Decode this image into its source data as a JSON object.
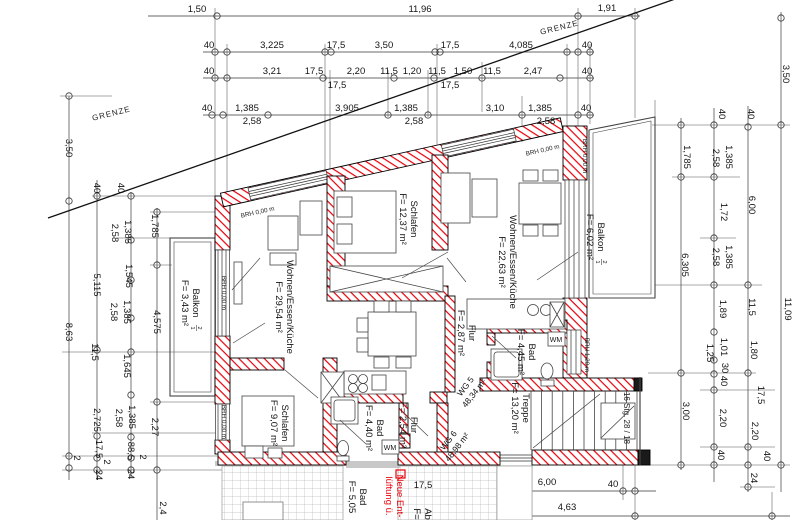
{
  "drawing": {
    "boundary_label_1": "GRENZE",
    "boundary_label_2": "GRENZE",
    "colors": {
      "wall_hatch": "#e8000a",
      "line": "#1c1c1c",
      "note_red": "#e8000a",
      "tile_joint": "#bbbbbb"
    }
  },
  "rooms": {
    "schlafen_top": {
      "name": "Schlafen",
      "area": "F= 12,37 m²"
    },
    "wohnen_right": {
      "name": "Wohnen/Essen/Küche",
      "area": "F= 22,63 m²"
    },
    "balkon_right": {
      "name": "Balkon",
      "num_top": "2",
      "num_bottom": "1",
      "area": "F= 6,02 m²"
    },
    "wohnen_left": {
      "name": "Wohnen/Essen/Küche",
      "area": "F= 29,54 m²"
    },
    "balkon_left": {
      "name": "Balkon",
      "num_top": "2",
      "num_bottom": "1",
      "area": "F= 3,43 m²"
    },
    "flur_right": {
      "name": "Flur",
      "area": "F= 2,87 m²"
    },
    "bad_right": {
      "name": "Bad",
      "area": "F= 4,45 m²"
    },
    "treppe": {
      "name": "Treppe",
      "area": "F= 13,20 m²"
    },
    "schlafen_bottom": {
      "name": "Schlafen",
      "area": "F= 9,07 m²"
    },
    "bad_bottom": {
      "name": "Bad",
      "area": "F= 4,40 m²"
    },
    "flur_bottom": {
      "name": "Flur",
      "area": "F= 2,54 m²"
    },
    "bad_cut": {
      "name": "Bad",
      "area": "F= 5,05"
    },
    "abstell_cut": {
      "name": "Ab",
      "area": "F="
    }
  },
  "apartments": {
    "wg5": {
      "name": "WG 5",
      "area": "48,34 m²"
    },
    "wg6": {
      "name": "WG 6",
      "area": "48,98 m²"
    }
  },
  "annotations": {
    "brh_000": "BRH 0,00 m",
    "brh_120": "BRH 1,20 m",
    "wm": "WM",
    "stairs": "16 Stg. 28 / 18",
    "note_line1": "Neue Ent-",
    "note_line2": "lüftung ü."
  },
  "dimensions": {
    "top1": [
      "1,50",
      "11,96",
      "1,91"
    ],
    "top2": [
      "40",
      "3,225",
      "17,5",
      "3,50",
      "17,5",
      "4,085",
      "40"
    ],
    "top3": [
      "40",
      "3,21",
      "17,5",
      "2,20",
      "11,5",
      "1,20",
      "11,5",
      "1,50",
      "11,5",
      "2,47",
      "40"
    ],
    "top3b": [
      "17,5",
      "17,5"
    ],
    "top4": [
      "40",
      "1,385",
      "3,905",
      "1,385",
      "3,10",
      "1,385",
      "40"
    ],
    "top4b": [
      "2,58",
      "2,58",
      "2,58"
    ],
    "left_a": [
      "3,50",
      "8,63",
      "2"
    ],
    "left_b": [
      "40",
      "5,115",
      "11,5",
      "2,725",
      "17,5",
      "2",
      "24"
    ],
    "left_c": [
      "40",
      "2,58",
      "1,385",
      "1,545",
      "2,58",
      "1,385",
      "1,645",
      "2,58",
      "1,385",
      "88,5",
      "2",
      "24"
    ],
    "left_d": [
      "1,785",
      "4,575",
      "2,27",
      "2,4"
    ],
    "right_a": [
      "1,785",
      "6,305",
      "3,00"
    ],
    "right_b": [
      "40",
      "2,58",
      "1,385",
      "1,72",
      "2,58",
      "1,385",
      "1,89",
      "1,25",
      "1,01",
      "30",
      "40",
      "2,20",
      "40"
    ],
    "right_c": [
      "40",
      "6,00",
      "11,5",
      "1,80",
      "17,5",
      "2,20",
      "40",
      "24"
    ],
    "right_d": [
      "3,50",
      "11,09"
    ],
    "bottom1": [
      "17,5",
      "6,00",
      "40"
    ],
    "bottom2": [
      "4,63"
    ]
  }
}
